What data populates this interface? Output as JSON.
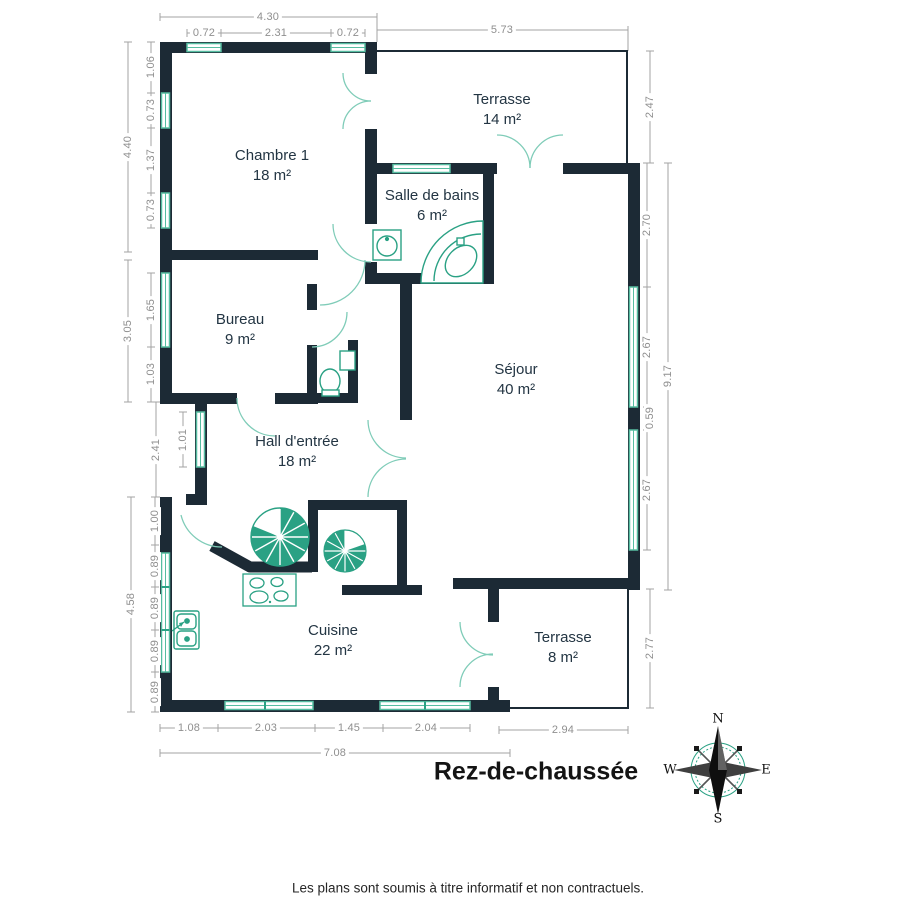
{
  "title": "Rez-de-chaussée",
  "disclaimer": "Les plans sont soumis à titre informatif et non contractuels.",
  "rooms": [
    {
      "name": "Chambre 1",
      "area": "18 m²"
    },
    {
      "name": "Terrasse",
      "area": "14 m²"
    },
    {
      "name": "Salle de bains",
      "area": "6 m²"
    },
    {
      "name": "Bureau",
      "area": "9 m²"
    },
    {
      "name": "Séjour",
      "area": "40 m²"
    },
    {
      "name": "Hall d'entrée",
      "area": "18 m²"
    },
    {
      "name": "Cuisine",
      "area": "22 m²"
    },
    {
      "name": "Terrasse",
      "area": "8 m²"
    }
  ],
  "dims": {
    "top_overall": "4.30",
    "top_segments": [
      "0.72",
      "2.31",
      "0.72"
    ],
    "top_terrace": "5.73",
    "left_upper_overall": "4.40",
    "left_upper_segments": [
      "1.06",
      "0.73",
      "1.37",
      "0.73"
    ],
    "left_mid_overall": "3.05",
    "left_mid_segments": [
      "1.65",
      "1.03"
    ],
    "left_hall": "2.41",
    "left_hall_window": "1.01",
    "left_lower_overall": "4.58",
    "left_lower_segments": [
      "1.00",
      "0.89",
      "0.89",
      "0.89",
      "0.89"
    ],
    "right_terrace_top": "2.47",
    "right_overall": "9.17",
    "right_segments": [
      "2.70",
      "2.67",
      "0.59",
      "2.67"
    ],
    "right_terrace_bottom": "2.77",
    "bottom_segments": [
      "1.08",
      "2.03",
      "1.45",
      "2.04"
    ],
    "bottom_overall": "7.08",
    "bottom_terrace": "2.94"
  },
  "compass": {
    "n": "N",
    "e": "E",
    "s": "S",
    "w": "W"
  },
  "fixtures": [
    "spiral-staircase-large",
    "spiral-staircase-small",
    "corner-bathtub",
    "bathroom-sink",
    "toilet",
    "kitchen-sink",
    "cooktop"
  ],
  "colors": {
    "wall": "#1c2a35",
    "fixture_teal": "#2aa184",
    "window_teal": "#56bda1",
    "door_arc": "#7fccb8",
    "dimension_gray": "#9c9c9c",
    "label_navy": "#233543"
  }
}
